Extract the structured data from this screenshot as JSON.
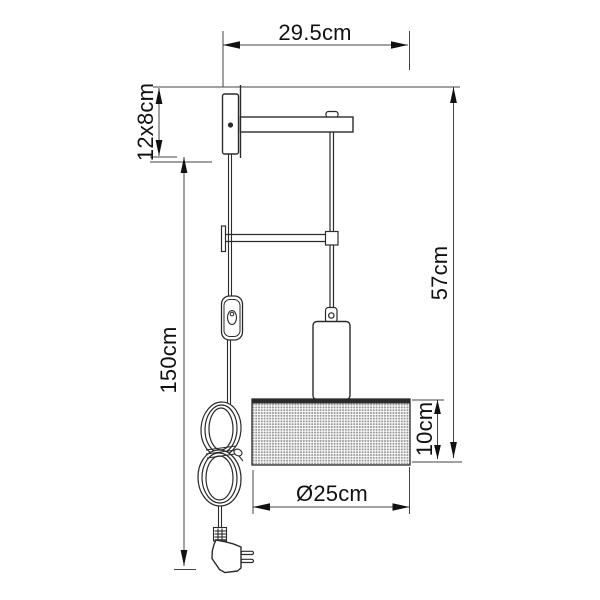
{
  "drawing": {
    "type": "product dimension diagram",
    "labels": {
      "width_total": "29.5cm",
      "bracket": "12x8cm",
      "cord_length": "150cm",
      "height_total": "57cm",
      "shade_height": "10cm",
      "shade_diameter": "Ø25cm"
    },
    "colors": {
      "object_line": "#2b2b2b",
      "dimension_line": "#444444",
      "text": "#111111",
      "mesh_dot": "#999999",
      "background": "#ffffff"
    }
  }
}
